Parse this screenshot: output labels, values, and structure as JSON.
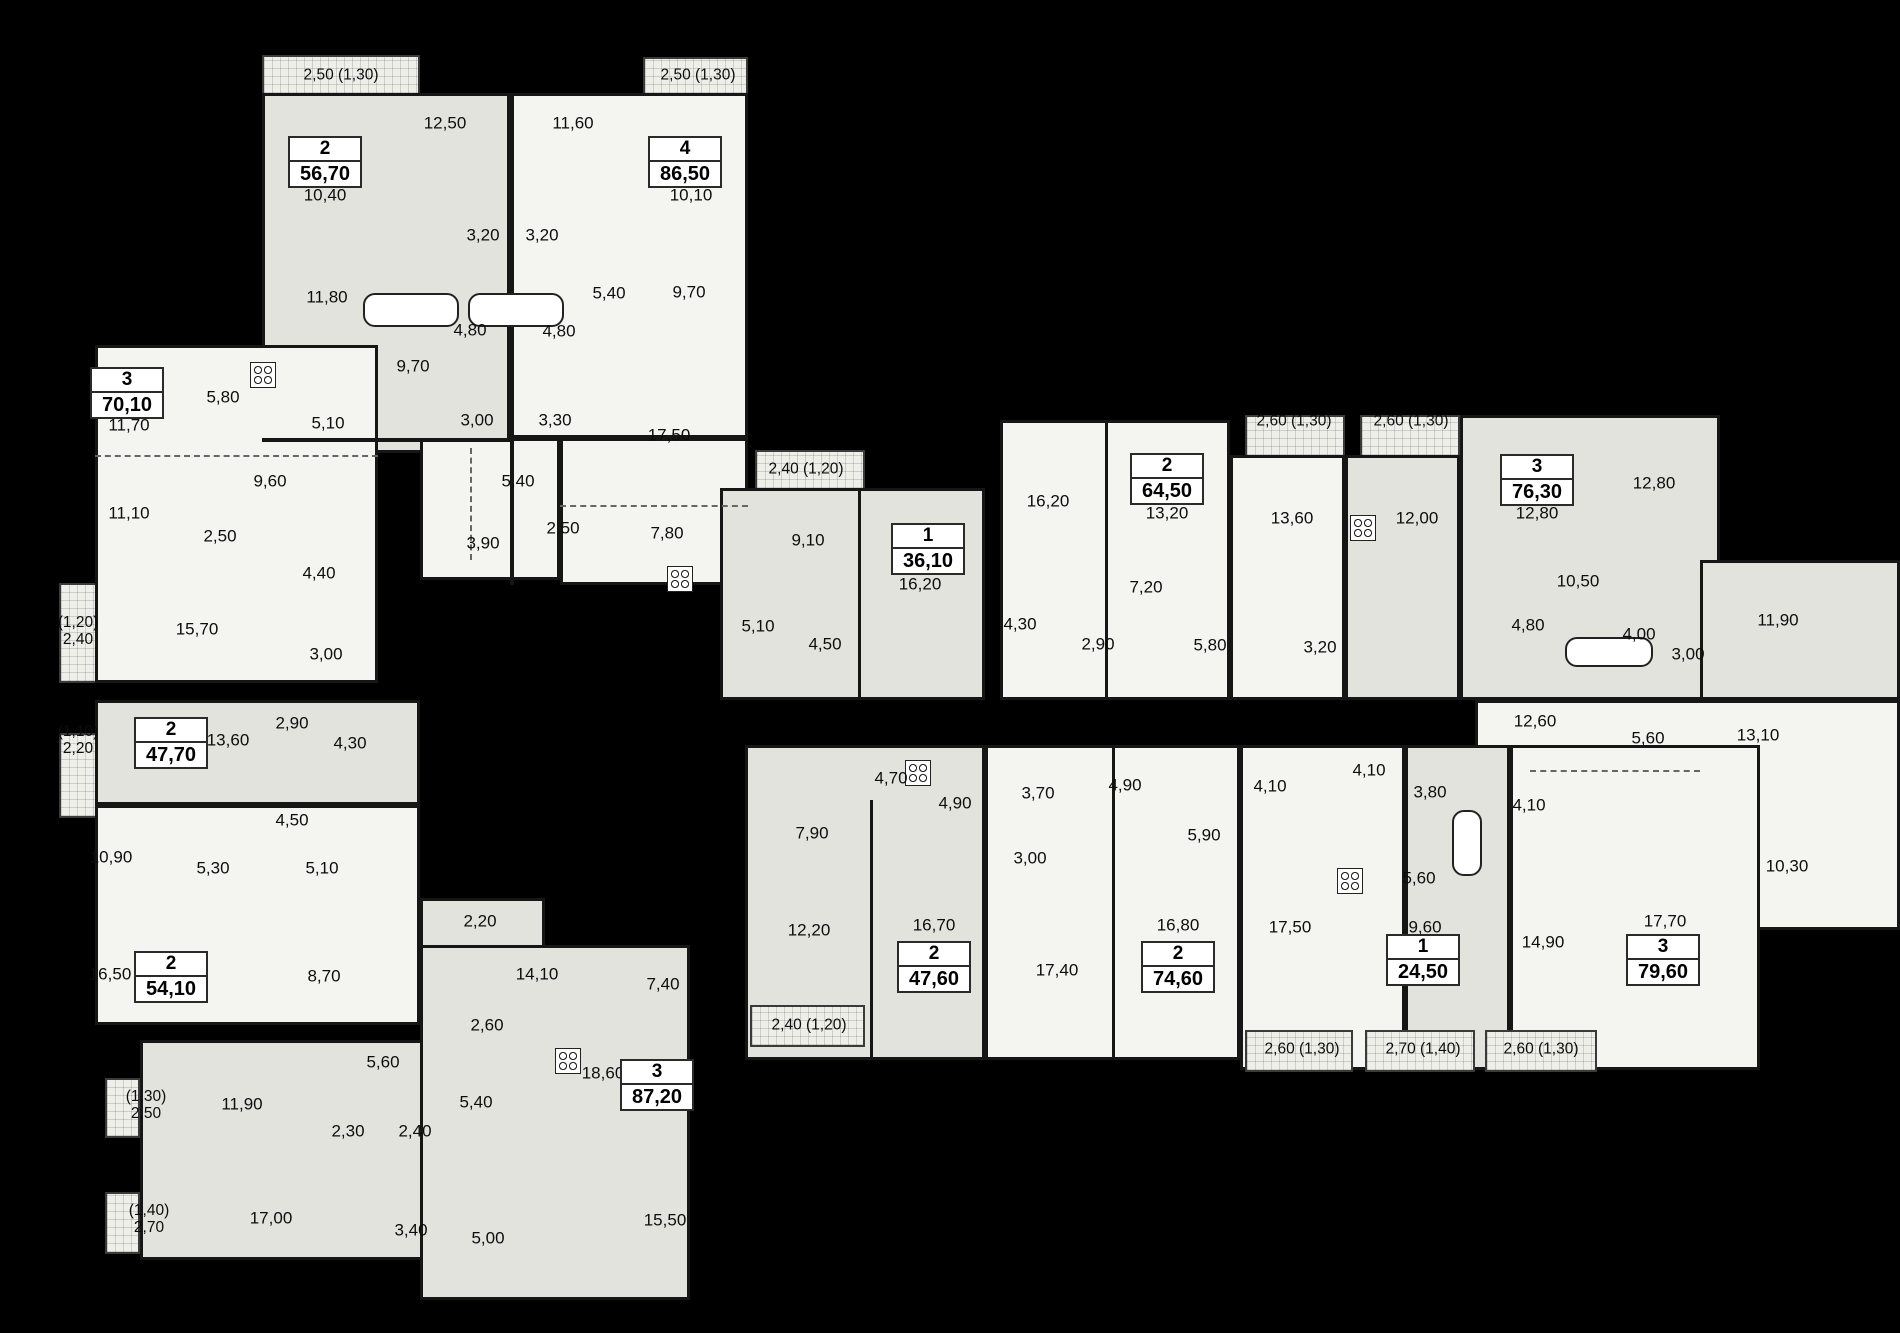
{
  "colors": {
    "background": "#000000",
    "wall": "#161616",
    "fill_light": "#f4f4f1",
    "fill_gray": "#e3e3de",
    "fill_hatch": "#efefea",
    "badge_bg": "#ffffff",
    "text": "#0d0d0d"
  },
  "apartments": [
    {
      "rooms": "2",
      "area": "56,70",
      "x": 325,
      "y": 162
    },
    {
      "rooms": "4",
      "area": "86,50",
      "x": 685,
      "y": 162
    },
    {
      "rooms": "3",
      "area": "70,10",
      "x": 127,
      "y": 393
    },
    {
      "rooms": "1",
      "area": "36,10",
      "x": 928,
      "y": 549
    },
    {
      "rooms": "2",
      "area": "64,50",
      "x": 1167,
      "y": 479
    },
    {
      "rooms": "3",
      "area": "76,30",
      "x": 1537,
      "y": 480
    },
    {
      "rooms": "2",
      "area": "47,70",
      "x": 171,
      "y": 743
    },
    {
      "rooms": "2",
      "area": "54,10",
      "x": 171,
      "y": 977
    },
    {
      "rooms": "3",
      "area": "87,20",
      "x": 657,
      "y": 1085
    },
    {
      "rooms": "2",
      "area": "47,60",
      "x": 934,
      "y": 967
    },
    {
      "rooms": "2",
      "area": "74,60",
      "x": 1178,
      "y": 967
    },
    {
      "rooms": "1",
      "area": "24,50",
      "x": 1423,
      "y": 960
    },
    {
      "rooms": "3",
      "area": "79,60",
      "x": 1663,
      "y": 960
    }
  ],
  "room_labels": [
    {
      "text": "12,50",
      "x": 445,
      "y": 123
    },
    {
      "text": "11,60",
      "x": 573,
      "y": 123
    },
    {
      "text": "10,40",
      "x": 325,
      "y": 195
    },
    {
      "text": "10,10",
      "x": 691,
      "y": 195
    },
    {
      "text": "3,20",
      "x": 483,
      "y": 235
    },
    {
      "text": "3,20",
      "x": 542,
      "y": 235
    },
    {
      "text": "11,80",
      "x": 327,
      "y": 297
    },
    {
      "text": "5,40",
      "x": 609,
      "y": 293
    },
    {
      "text": "9,70",
      "x": 689,
      "y": 292
    },
    {
      "text": "4,80",
      "x": 470,
      "y": 330
    },
    {
      "text": "4,80",
      "x": 559,
      "y": 331
    },
    {
      "text": "9,70",
      "x": 413,
      "y": 366
    },
    {
      "text": "3,00",
      "x": 477,
      "y": 420
    },
    {
      "text": "3,30",
      "x": 555,
      "y": 420
    },
    {
      "text": "17,50",
      "x": 669,
      "y": 435
    },
    {
      "text": "5,40",
      "x": 518,
      "y": 481
    },
    {
      "text": "3,90",
      "x": 483,
      "y": 543
    },
    {
      "text": "2,50",
      "x": 563,
      "y": 528
    },
    {
      "text": "7,80",
      "x": 667,
      "y": 533
    },
    {
      "text": "11,70",
      "x": 129,
      "y": 425
    },
    {
      "text": "5,80",
      "x": 223,
      "y": 397
    },
    {
      "text": "5,10",
      "x": 328,
      "y": 423
    },
    {
      "text": "9,60",
      "x": 270,
      "y": 481
    },
    {
      "text": "11,10",
      "x": 129,
      "y": 513
    },
    {
      "text": "2,50",
      "x": 220,
      "y": 536
    },
    {
      "text": "4,40",
      "x": 319,
      "y": 573
    },
    {
      "text": "15,70",
      "x": 197,
      "y": 629
    },
    {
      "text": "3,00",
      "x": 326,
      "y": 654
    },
    {
      "text": "9,10",
      "x": 808,
      "y": 540
    },
    {
      "text": "16,20",
      "x": 920,
      "y": 584
    },
    {
      "text": "5,10",
      "x": 758,
      "y": 626
    },
    {
      "text": "4,50",
      "x": 825,
      "y": 644
    },
    {
      "text": "16,20",
      "x": 1048,
      "y": 501
    },
    {
      "text": "13,20",
      "x": 1167,
      "y": 513
    },
    {
      "text": "13,60",
      "x": 1292,
      "y": 518
    },
    {
      "text": "12,00",
      "x": 1417,
      "y": 518
    },
    {
      "text": "12,80",
      "x": 1537,
      "y": 513
    },
    {
      "text": "12,80",
      "x": 1654,
      "y": 483
    },
    {
      "text": "7,20",
      "x": 1146,
      "y": 587
    },
    {
      "text": "4,30",
      "x": 1020,
      "y": 624
    },
    {
      "text": "2,90",
      "x": 1098,
      "y": 644
    },
    {
      "text": "5,80",
      "x": 1210,
      "y": 645
    },
    {
      "text": "3,20",
      "x": 1320,
      "y": 647
    },
    {
      "text": "10,50",
      "x": 1578,
      "y": 581
    },
    {
      "text": "4,80",
      "x": 1528,
      "y": 625
    },
    {
      "text": "4,00",
      "x": 1639,
      "y": 634
    },
    {
      "text": "3,00",
      "x": 1688,
      "y": 654
    },
    {
      "text": "11,90",
      "x": 1778,
      "y": 620
    },
    {
      "text": "12,60",
      "x": 1535,
      "y": 721
    },
    {
      "text": "5,60",
      "x": 1648,
      "y": 738
    },
    {
      "text": "13,10",
      "x": 1758,
      "y": 735
    },
    {
      "text": "10,30",
      "x": 1787,
      "y": 866
    },
    {
      "text": "13,60",
      "x": 228,
      "y": 740
    },
    {
      "text": "2,90",
      "x": 292,
      "y": 723
    },
    {
      "text": "4,30",
      "x": 350,
      "y": 743
    },
    {
      "text": "4,50",
      "x": 292,
      "y": 820
    },
    {
      "text": "10,90",
      "x": 111,
      "y": 857
    },
    {
      "text": "5,30",
      "x": 213,
      "y": 868
    },
    {
      "text": "5,10",
      "x": 322,
      "y": 868
    },
    {
      "text": "16,50",
      "x": 110,
      "y": 974
    },
    {
      "text": "8,70",
      "x": 324,
      "y": 976
    },
    {
      "text": "2,20",
      "x": 480,
      "y": 921
    },
    {
      "text": "14,10",
      "x": 537,
      "y": 974
    },
    {
      "text": "7,40",
      "x": 663,
      "y": 984
    },
    {
      "text": "2,60",
      "x": 487,
      "y": 1025
    },
    {
      "text": "5,60",
      "x": 383,
      "y": 1062
    },
    {
      "text": "18,60",
      "x": 603,
      "y": 1073
    },
    {
      "text": "11,90",
      "x": 242,
      "y": 1104
    },
    {
      "text": "2,30",
      "x": 348,
      "y": 1131
    },
    {
      "text": "2,40",
      "x": 415,
      "y": 1131
    },
    {
      "text": "5,40",
      "x": 476,
      "y": 1102
    },
    {
      "text": "17,00",
      "x": 271,
      "y": 1218
    },
    {
      "text": "3,40",
      "x": 411,
      "y": 1230
    },
    {
      "text": "5,00",
      "x": 488,
      "y": 1238
    },
    {
      "text": "15,50",
      "x": 665,
      "y": 1220
    },
    {
      "text": "4,70",
      "x": 891,
      "y": 778
    },
    {
      "text": "4,90",
      "x": 955,
      "y": 803
    },
    {
      "text": "3,70",
      "x": 1038,
      "y": 793
    },
    {
      "text": "4,90",
      "x": 1125,
      "y": 785
    },
    {
      "text": "7,90",
      "x": 812,
      "y": 833
    },
    {
      "text": "3,00",
      "x": 1030,
      "y": 858
    },
    {
      "text": "12,20",
      "x": 809,
      "y": 930
    },
    {
      "text": "16,70",
      "x": 934,
      "y": 925
    },
    {
      "text": "17,40",
      "x": 1057,
      "y": 970
    },
    {
      "text": "16,80",
      "x": 1178,
      "y": 925
    },
    {
      "text": "5,90",
      "x": 1204,
      "y": 835
    },
    {
      "text": "4,10",
      "x": 1270,
      "y": 786
    },
    {
      "text": "4,10",
      "x": 1369,
      "y": 770
    },
    {
      "text": "3,80",
      "x": 1430,
      "y": 792
    },
    {
      "text": "4,10",
      "x": 1529,
      "y": 805
    },
    {
      "text": "5,60",
      "x": 1419,
      "y": 878
    },
    {
      "text": "17,50",
      "x": 1290,
      "y": 927
    },
    {
      "text": "9,60",
      "x": 1425,
      "y": 927
    },
    {
      "text": "14,90",
      "x": 1543,
      "y": 942
    },
    {
      "text": "17,70",
      "x": 1665,
      "y": 921
    }
  ],
  "balcony_labels": [
    {
      "text": "2,50 (1,30)",
      "x": 341,
      "y": 75
    },
    {
      "text": "2,50 (1,30)",
      "x": 698,
      "y": 75
    },
    {
      "text": "2,40 (1,20)",
      "x": 806,
      "y": 469
    },
    {
      "text": "2,60 (1,30)",
      "x": 1294,
      "y": 421
    },
    {
      "text": "2,60 (1,30)",
      "x": 1411,
      "y": 421
    },
    {
      "text": "(1,20)\n2,40",
      "x": 78,
      "y": 631
    },
    {
      "text": "(1,10)\n2,20",
      "x": 78,
      "y": 740
    },
    {
      "text": "(1,30)\n2,50",
      "x": 146,
      "y": 1105
    },
    {
      "text": "(1,40)\n2,70",
      "x": 149,
      "y": 1219
    },
    {
      "text": "2,40 (1,20)",
      "x": 809,
      "y": 1025
    },
    {
      "text": "2,60 (1,30)",
      "x": 1302,
      "y": 1049
    },
    {
      "text": "2,70 (1,40)",
      "x": 1423,
      "y": 1049
    },
    {
      "text": "2,60 (1,30)",
      "x": 1541,
      "y": 1049
    }
  ]
}
